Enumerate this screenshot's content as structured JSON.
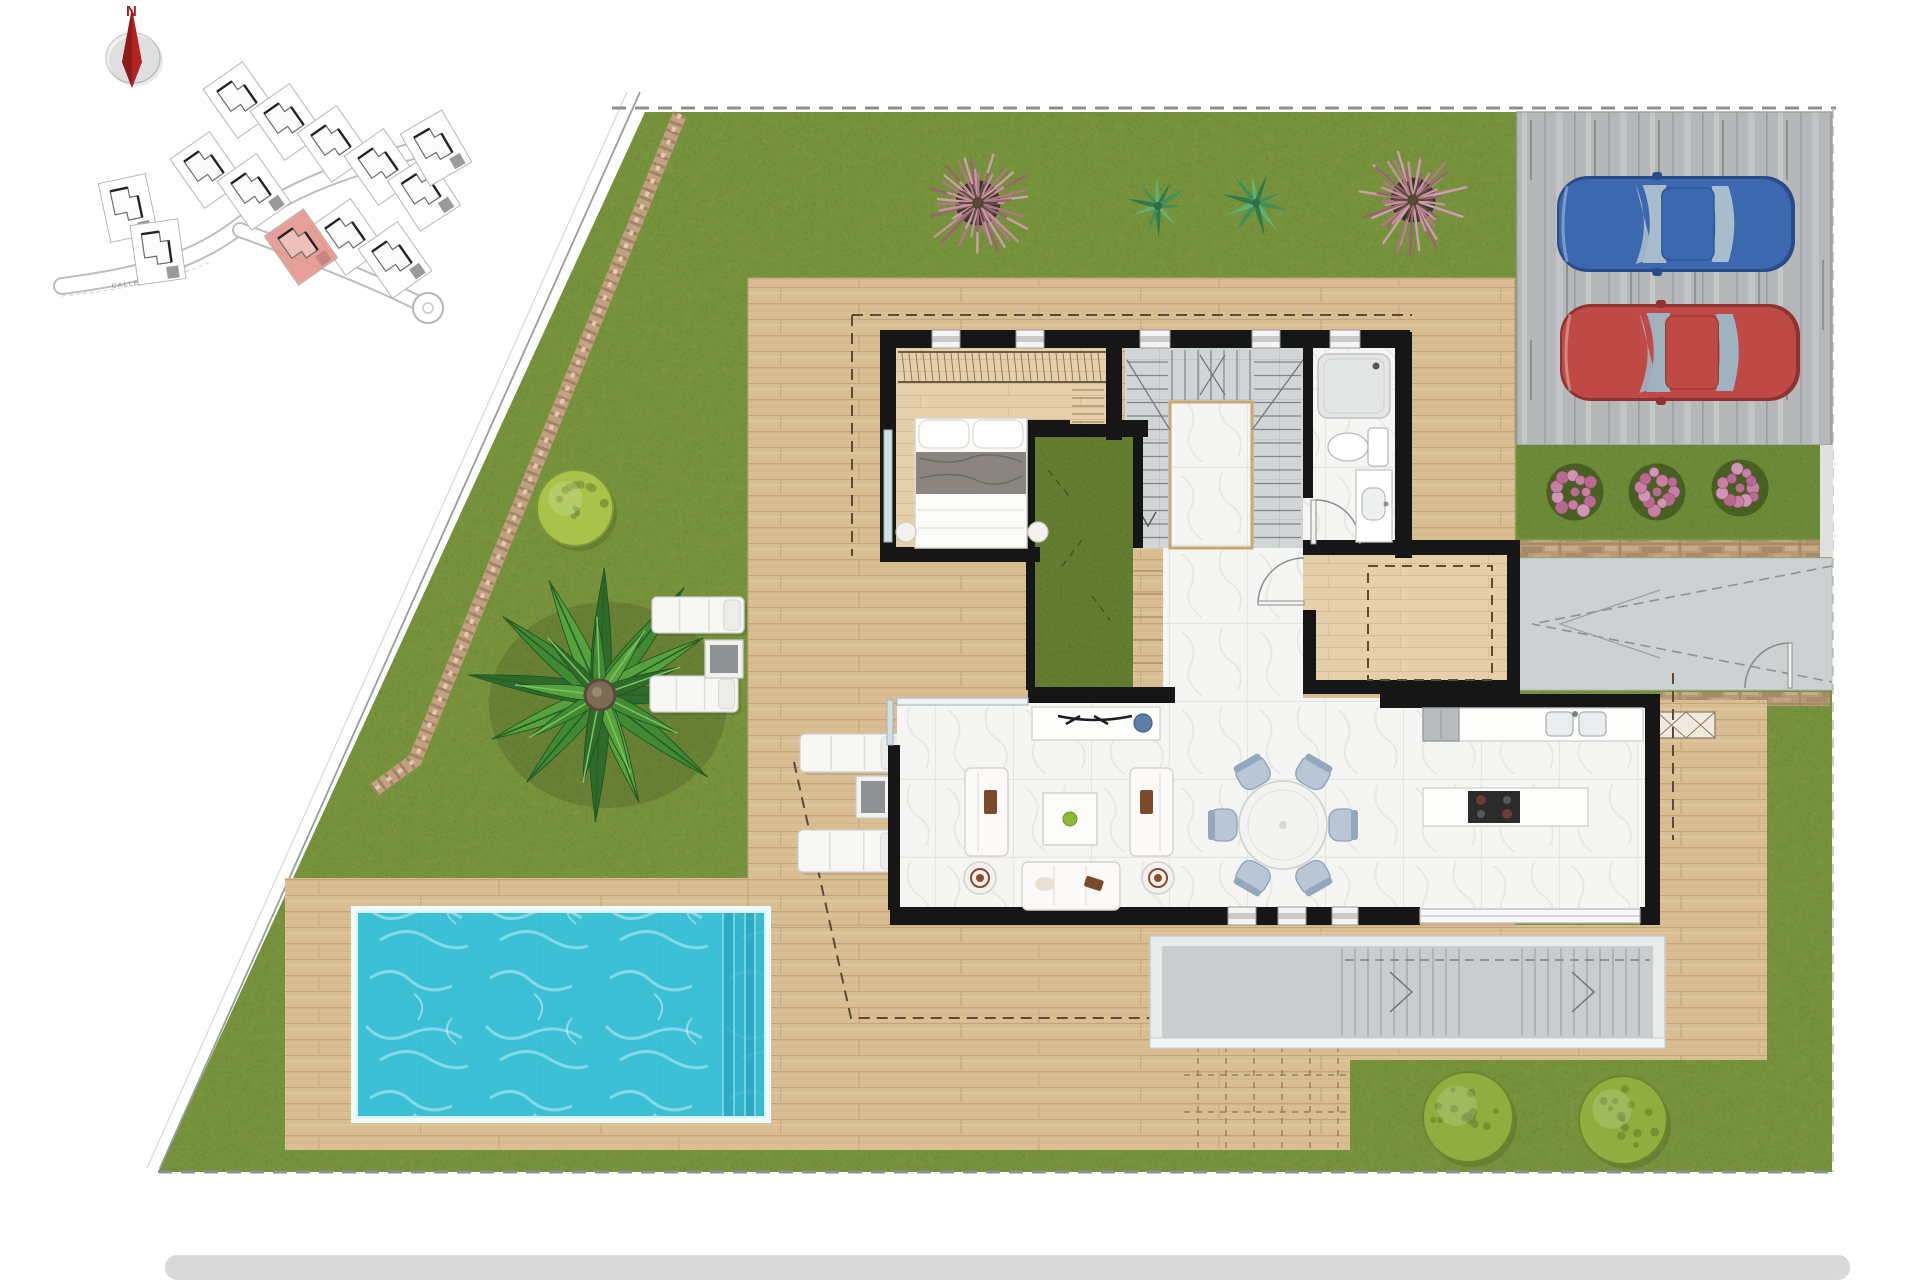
{
  "compass": {
    "north_label": "N"
  },
  "site_map": {
    "street_label": "CALLE",
    "highlight_color": "#e5968f",
    "plots": [
      {
        "x": 240,
        "y": 100,
        "rot": -35
      },
      {
        "x": 287,
        "y": 122,
        "rot": -35
      },
      {
        "x": 334,
        "y": 144,
        "rot": -35
      },
      {
        "x": 381,
        "y": 167,
        "rot": -35
      },
      {
        "x": 424,
        "y": 193,
        "rot": -33
      },
      {
        "x": 207,
        "y": 170,
        "rot": -35
      },
      {
        "x": 254,
        "y": 192,
        "rot": -35
      },
      {
        "x": 348,
        "y": 237,
        "rot": -35
      },
      {
        "x": 395,
        "y": 260,
        "rot": -35
      },
      {
        "x": 128,
        "y": 208,
        "rot": -12
      },
      {
        "x": 158,
        "y": 252,
        "rot": -8
      },
      {
        "x": 436,
        "y": 148,
        "rot": -30
      }
    ],
    "highlight_plot": {
      "x": 301,
      "y": 247,
      "rot": -35
    }
  },
  "palette": {
    "grass": "#76923c",
    "grass_speckle": "#51682a",
    "courtyard_grass": "#647d31",
    "deck_wood": "#d9be94",
    "deck_line": "#c3a478",
    "interior_wood": "#e6d0ab",
    "marble": "#f5f5f3",
    "stair_tile": "#d2d5d6",
    "wall": "#161616",
    "pool_water": "#3bc0d6",
    "pool_steps": "#2aa8c0",
    "driveway_concrete": "#b5b7b8",
    "path_concrete": "#ced1d2",
    "stone_wall": "#b69a76",
    "gravel_path": "#c2a183",
    "footer_bar": "#d9d9d9",
    "boundary_dash": "#8f8f8f",
    "compass_red": "#b32424"
  },
  "landscape": {
    "pink_bursts": [
      {
        "x": 978,
        "y": 203,
        "r": 56
      },
      {
        "x": 1413,
        "y": 200,
        "r": 56
      }
    ],
    "pink_colors": [
      "#c495a1",
      "#b27786",
      "#caa0ab",
      "#9c6273"
    ],
    "fan_palms": [
      {
        "x": 1158,
        "y": 206,
        "r": 30
      },
      {
        "x": 1256,
        "y": 203,
        "r": 32
      }
    ],
    "fan_colors": [
      "#3f8f5a",
      "#63b06f",
      "#2f7a4a"
    ],
    "palm_tree": {
      "x": 600,
      "y": 695,
      "r": 132
    },
    "palm_colors": [
      "#2e6b2a",
      "#3f8a33",
      "#55a23e"
    ],
    "round_bushes": [
      {
        "x": 575,
        "y": 508,
        "r": 38,
        "fill": "#a8c24a",
        "rim": "#7d9636"
      },
      {
        "x": 1468,
        "y": 1117,
        "r": 45,
        "fill": "#8fae3f",
        "rim": "#6b852c"
      },
      {
        "x": 1623,
        "y": 1120,
        "r": 44,
        "fill": "#8fae3f",
        "rim": "#6b852c"
      }
    ],
    "flower_clusters": [
      {
        "x": 1575,
        "y": 492,
        "r": 30
      },
      {
        "x": 1657,
        "y": 492,
        "r": 30
      },
      {
        "x": 1740,
        "y": 488,
        "r": 30
      }
    ],
    "flower_colors": [
      "#c77fa3",
      "#b86b92",
      "#d096b4"
    ]
  },
  "driveway": {
    "cars": [
      {
        "name": "blue-car",
        "body": "#3c68b0",
        "shade": "#294b88",
        "glass": "#a9bccb",
        "x": 1557,
        "y": 176,
        "w": 238,
        "h": 96
      },
      {
        "name": "red-car",
        "body": "#bf4a45",
        "shade": "#8f3330",
        "glass": "#9fb2c0",
        "x": 1560,
        "y": 304,
        "w": 240,
        "h": 97
      }
    ]
  },
  "pool": {
    "x": 357,
    "y": 912,
    "w": 408,
    "h": 205,
    "step_count": 4
  },
  "furniture": {
    "loungers": [
      {
        "x": 652,
        "y": 597,
        "w": 92,
        "h": 36
      },
      {
        "x": 650,
        "y": 676,
        "w": 88,
        "h": 36
      },
      {
        "x": 800,
        "y": 734,
        "w": 104,
        "h": 38
      },
      {
        "x": 798,
        "y": 830,
        "w": 106,
        "h": 42
      }
    ],
    "side_tables": [
      {
        "x": 705,
        "y": 640,
        "w": 38,
        "h": 38
      },
      {
        "x": 856,
        "y": 776,
        "w": 34,
        "h": 42
      }
    ],
    "dining": {
      "cx": 1283,
      "cy": 825,
      "table_r": 44,
      "chair_angles": [
        -120,
        -60,
        180,
        0,
        120,
        60
      ]
    }
  }
}
